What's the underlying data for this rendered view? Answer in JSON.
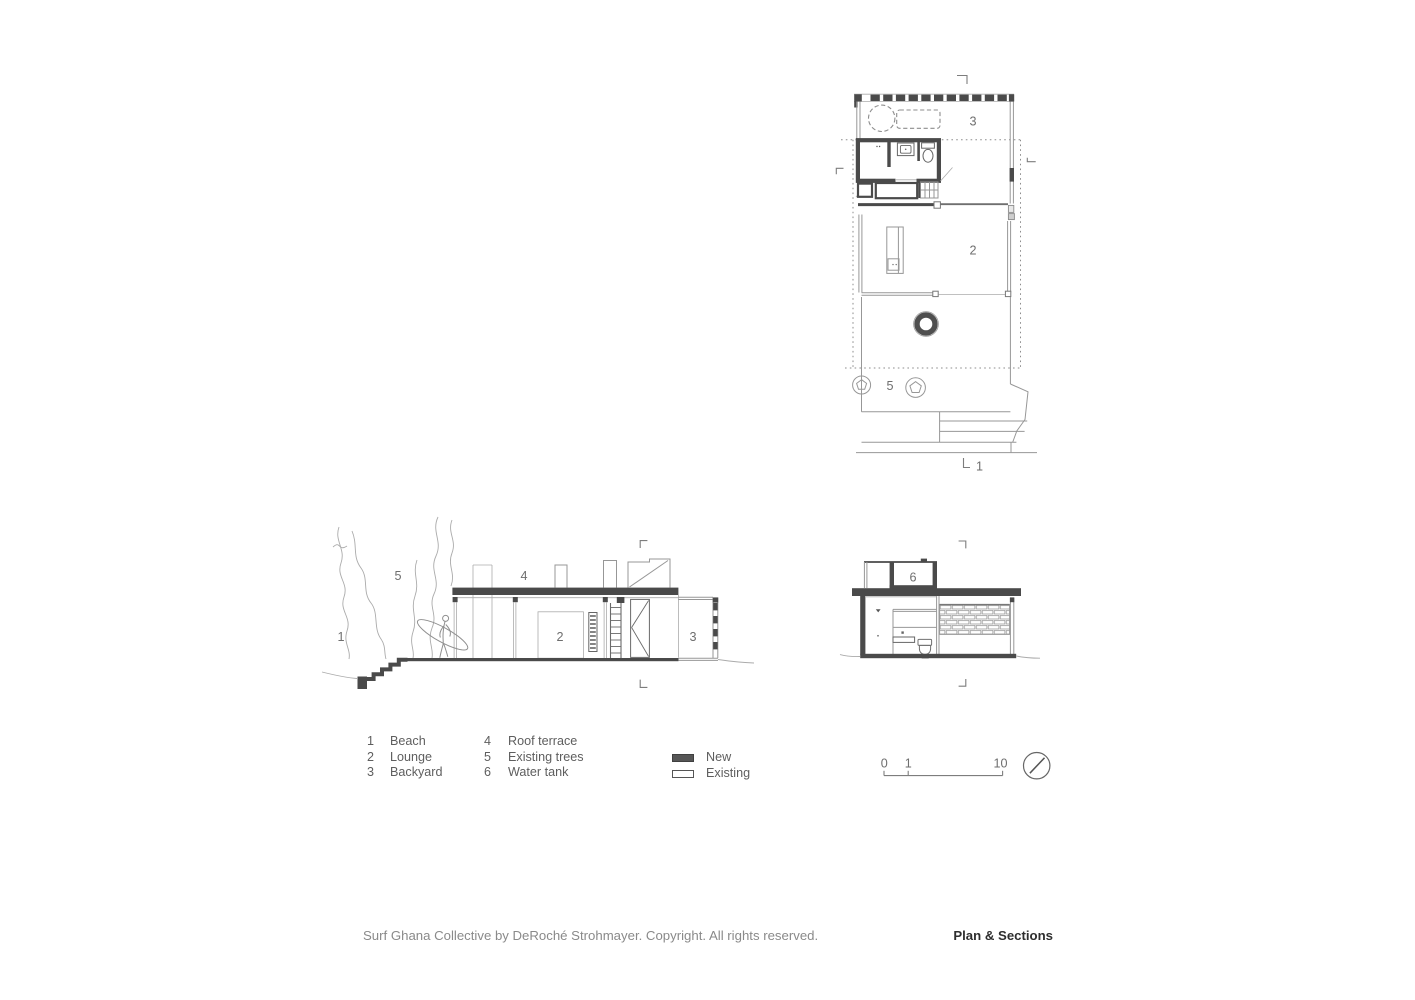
{
  "drawing": {
    "type": "architectural-sheet",
    "colors": {
      "new": "#4a4a4a",
      "existing_line": "#979797",
      "boundary": "#8d8d8d",
      "label_text": "#6e6e6e"
    }
  },
  "plan": {
    "labels": {
      "backyard": "3",
      "lounge": "2",
      "existing_trees": "5"
    },
    "section_cut_label": "1"
  },
  "section_long": {
    "labels": {
      "beach": "1",
      "lounge": "2",
      "backyard": "3",
      "roof_terrace": "4",
      "existing_trees": "5"
    }
  },
  "section_cross": {
    "labels": {
      "water_tank": "6"
    }
  },
  "legend": {
    "items": [
      {
        "num": "1",
        "label": "Beach"
      },
      {
        "num": "2",
        "label": "Lounge"
      },
      {
        "num": "3",
        "label": "Backyard"
      },
      {
        "num": "4",
        "label": "Roof terrace"
      },
      {
        "num": "5",
        "label": "Existing trees"
      },
      {
        "num": "6",
        "label": "Water tank"
      }
    ],
    "materials": [
      {
        "label": "New",
        "swatch": "#565656"
      },
      {
        "label": "Existing",
        "swatch": "#ffffff"
      }
    ]
  },
  "scale_bar": {
    "tick0": "0",
    "tick1": "1",
    "tick10": "10"
  },
  "footer": {
    "copyright": "Surf Ghana Collective by DeRoché Strohmayer. Copyright. All rights reserved.",
    "sheet_title": "Plan & Sections"
  }
}
